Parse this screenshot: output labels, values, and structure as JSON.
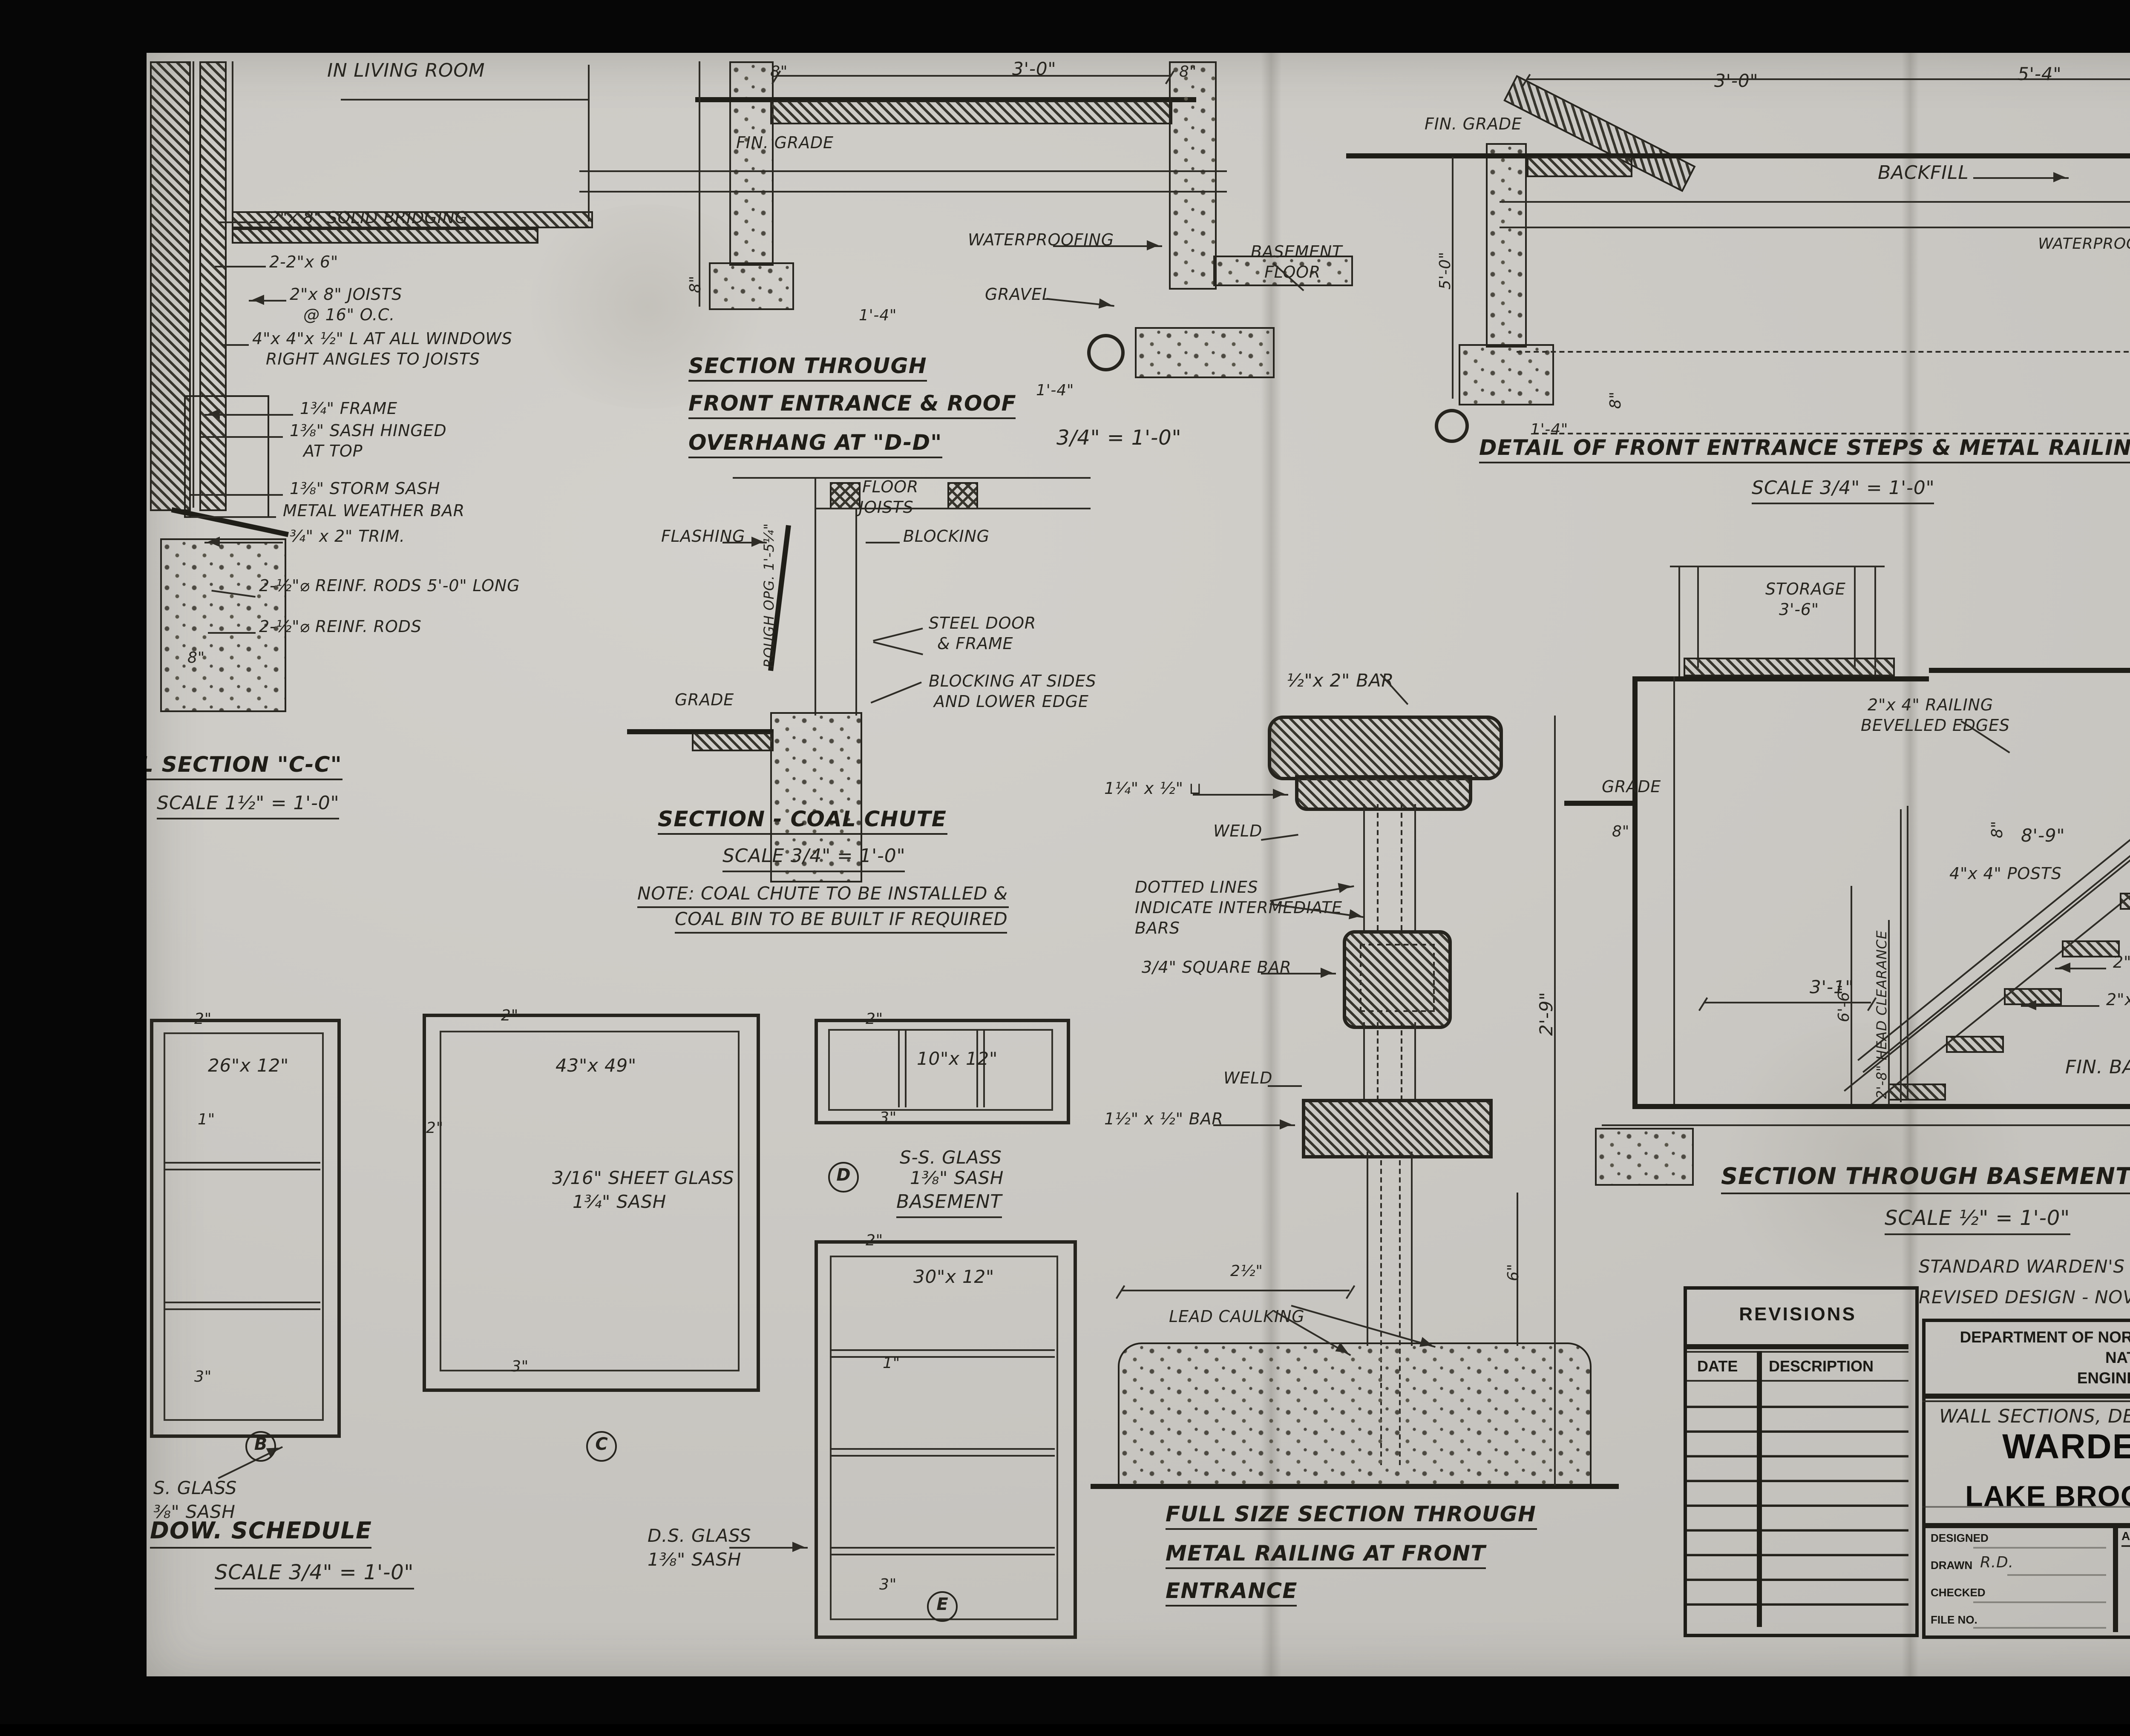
{
  "drawing": {
    "section_cc": {
      "room": "IN LIVING ROOM",
      "bridging": "2\"x 8\" SOLID BRIDGING",
      "two_2x6": "2-2\"x 6\"",
      "joists": "2\"x 8\" JOISTS",
      "joists2": "@ 16\" O.C.",
      "angle": "4\"x 4\"x ½\" L AT ALL WINDOWS",
      "angle2": "RIGHT ANGLES TO JOISTS",
      "frame": "1¾\" FRAME",
      "sash_hinged": "1⅜\" SASH HINGED",
      "sash_hinged2": "AT TOP",
      "storm_sash": "1⅜\" STORM SASH",
      "weather_bar": "METAL WEATHER BAR",
      "trim": "¾\" x 2\" TRIM.",
      "rods_long": "2-½\"⌀ REINF. RODS 5'-0\" LONG",
      "rods": "2-½\"⌀ REINF. RODS",
      "dim8": "8\"",
      "title": "L SECTION \"C-C\"",
      "scale": "SCALE 1½\" = 1'-0\""
    },
    "section_dd": {
      "fin_grade": "FIN. GRADE",
      "dim8_left": "8\"",
      "dim30": "3'-0\"",
      "dim8_right": "8\"",
      "waterproofing": "WATERPROOFING",
      "gravel": "GRAVEL",
      "basement1": "BASEMENT",
      "basement2": "FLOOR",
      "dim14_left": "1'-4\"",
      "dim14_right": "1'-4\"",
      "dim8_vert": "8\"",
      "title1": "SECTION THROUGH",
      "title2": "FRONT ENTRANCE & ROOF",
      "title3": "OVERHANG AT \"D-D\"",
      "title3b": "3/4\" = 1'-0\""
    },
    "coal_chute": {
      "floor1": "FLOOR",
      "floor2": "JOISTS",
      "flashing": "FLASHING",
      "blocking": "BLOCKING",
      "rough_opg": "ROUGH OPG. 1'-5¼\"",
      "steel1": "STEEL DOOR",
      "steel2": "& FRAME",
      "blk_sides1": "BLOCKING AT SIDES",
      "blk_sides2": "AND LOWER EDGE",
      "grade": "GRADE",
      "title": "SECTION - COAL CHUTE",
      "scale": "SCALE 3/4\" = 1'-0\"",
      "note1": "NOTE: COAL CHUTE TO BE INSTALLED &",
      "note2": "COAL BIN TO BE BUILT IF REQUIRED"
    },
    "railing": {
      "bar_top": "½\"x 2\" BAR",
      "channel": "1¼\" x ½\" ⊔",
      "weld1": "WELD",
      "dotted1": "DOTTED LINES",
      "dotted2": "INDICATE INTERMEDIATE",
      "dotted3": "BARS",
      "square_bar": "3/4\" SQUARE BAR",
      "weld2": "WELD",
      "bar_bottom": "1½\" x ½\" BAR",
      "dim29": "2'-9\"",
      "dim6": "6\"",
      "dim2half": "2½\"",
      "lead": "LEAD CAULKING",
      "title1": "FULL SIZE SECTION THROUGH",
      "title2": "METAL RAILING AT FRONT",
      "title3": "ENTRANCE"
    },
    "steps": {
      "fin_grade": "FIN. GRADE",
      "dim30": "3'-0\"",
      "dim54": "5'-4\"",
      "dim8": "8\"",
      "backfill": "BACKFILL",
      "waterproofing": "WATERPROOFING",
      "bars": "2-½\"⌀ BARS",
      "dim50": "5'-0\"",
      "dim8v": "8\"",
      "dim14": "1'-4\"",
      "title": "DETAIL OF FRONT ENTRANCE STEPS & METAL RAILING",
      "scale": "SCALE 3/4\" = 1'-0\""
    },
    "stairs": {
      "storage1": "STORAGE",
      "storage2": "3'-6\"",
      "first_floor": "FIRST FLOOR",
      "railing1": "2\"x 4\" RAILING",
      "railing2": "BEVELLED EDGES",
      "dim8_tread": "8\"",
      "grade": "GRADE",
      "dim8": "8\"",
      "dim89": "8'-9\"",
      "posts": "4\"x 4\" POSTS",
      "dim66": "6'-6\"",
      "head_clear": "2'-8\" HEAD CLEARANCE",
      "dim8v": "8\"",
      "dim31": "3'-1\"",
      "tread": "2\"x 10\" TREAD",
      "stringer": "2\"x 10\" STRINGER",
      "fin_basement": "FIN. BASEMENT FLOOR",
      "title": "SECTION THROUGH BASEMENT STAIRS",
      "scale": "SCALE ½\" = 1'-0\""
    },
    "schedule": {
      "title": "DOW. SCHEDULE",
      "scale": "SCALE 3/4\" = 1'-0\"",
      "b": {
        "dim2": "2\"",
        "size": "26\"x 12\"",
        "dim1": "1\"",
        "dim3": "3\"",
        "glass1": "S. GLASS",
        "glass2": "⅜\" SASH",
        "label": "B"
      },
      "c": {
        "dim2": "2\"",
        "size": "43\"x 49\"",
        "dim2l": "2\"",
        "glass1": "3/16\" SHEET GLASS",
        "glass2": "1¾\" SASH",
        "dim3": "3\"",
        "label": "C"
      },
      "d": {
        "dim2": "2\"",
        "size": "10\"x 12\"",
        "dim3": "3\"",
        "glass1": "S-S. GLASS",
        "glass2": "1⅜\" SASH",
        "room": "BASEMENT",
        "label": "D"
      },
      "e": {
        "dim2": "2\"",
        "size": "30\"x 12\"",
        "dim1": "1\"",
        "dim3": "3\"",
        "glass1": "D.S. GLASS",
        "glass2": "1⅜\" SASH",
        "label": "E"
      }
    }
  },
  "revisions": {
    "title": "REVISIONS",
    "col_date": "DATE",
    "col_desc": "DESCRIPTION"
  },
  "title_block": {
    "note1": "STANDARD WARDEN'S RESIDENCE - TYPE N.P.20.",
    "note2": "REVISED DESIGN - NOV. 1955.",
    "dept1": "DEPARTMENT OF NORTHERN AFFAIRS & NATIONAL RESOURCES",
    "dept2": "NATIONAL PARKS BRANCH",
    "dept3": "ENGINEERING SERVICES DIVISION",
    "subject": "WALL SECTIONS, DETAILS.",
    "stamp1": "WARDEN'S RESIDENCE",
    "stamp2": "LAKE BROOK  N.I.D. FUNDY  N.P.",
    "designed": "DESIGNED",
    "drawn": "DRAWN",
    "drawn_val": "R.D.",
    "checked": "CHECKED",
    "file_no": "FILE NO.",
    "approved": "APPROVED",
    "chief_engineer": "CHIEF ENGINEER",
    "index_label": "INDEX NO",
    "index_no": "F-29",
    "sheet_label": "SHEET NO",
    "sheet_num": "3",
    "sheet_den": "4"
  },
  "page": {
    "corner_stamp": "4  OF/DE  4"
  },
  "colors": {
    "paper": "#cac8c3",
    "ink": "#27251f",
    "stamp_ink": "#0e0d0b",
    "background": "#050505"
  }
}
